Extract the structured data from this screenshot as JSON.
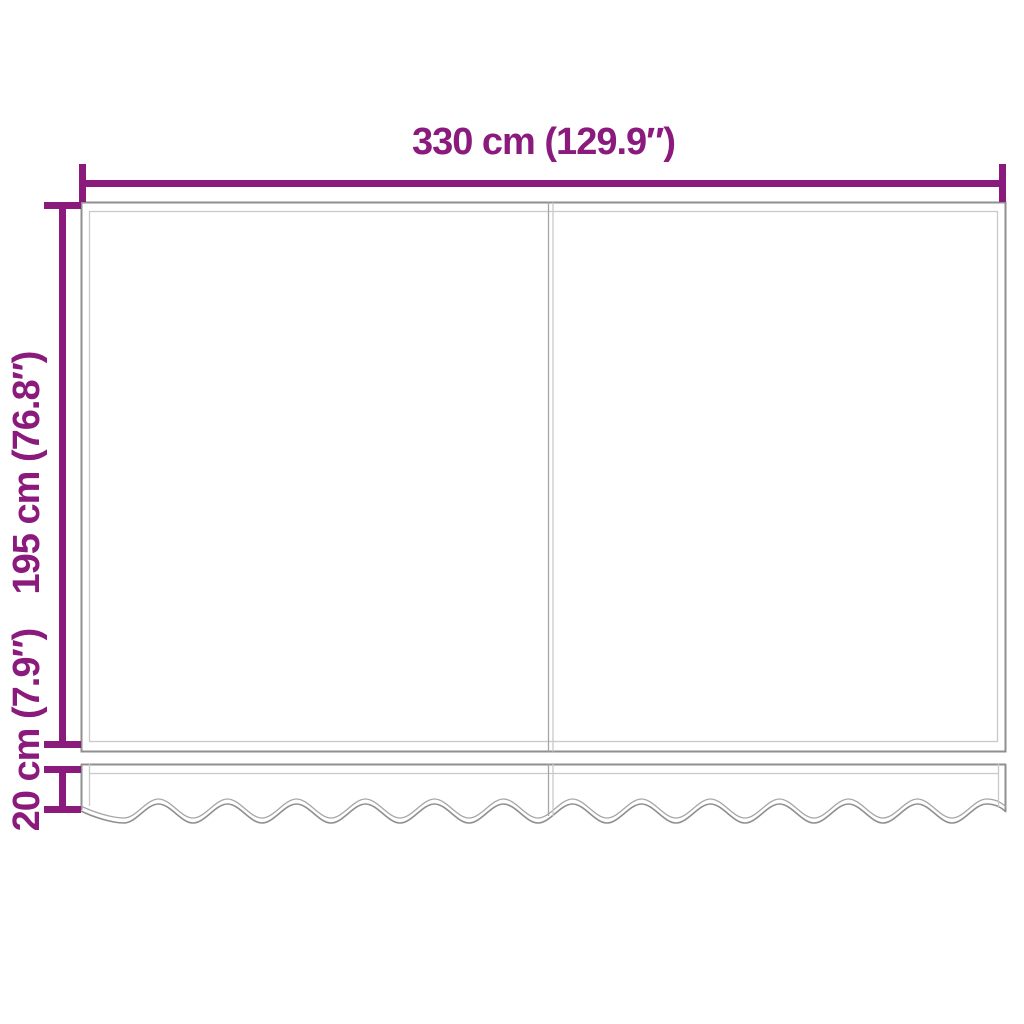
{
  "diagram": {
    "name": "awning-replacement-fabric-dimension-diagram",
    "labels": {
      "width": "330 cm (129.9″)",
      "height": "195 cm (76.8″)",
      "valance_height": "20 cm (7.9″)"
    },
    "parts": {
      "main_panel": "awning fabric (two panels with center seam)",
      "valance": "wavy-edged valance strip"
    },
    "colors": {
      "dimension": "#8B1A7D",
      "outline-dark": "#8F8F8F",
      "outline-mid": "#A6A6A6",
      "outline-light": "#C9C9C9",
      "background": "#FFFFFF"
    }
  }
}
